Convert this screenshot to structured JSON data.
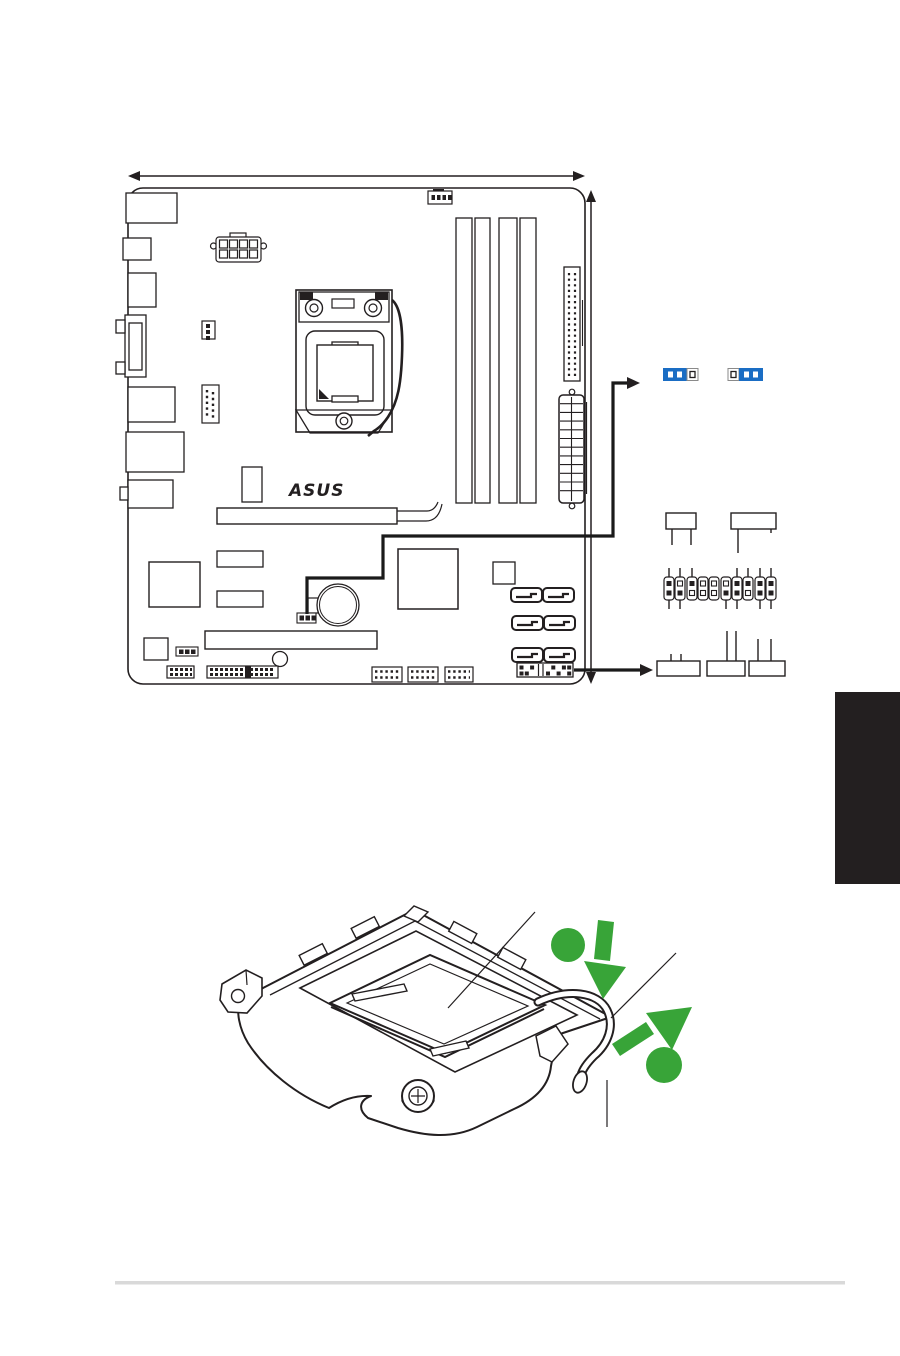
{
  "page": {
    "background": "#ffffff",
    "width": 900,
    "height": 1356,
    "footer_divider_color": "#d9d9d9"
  },
  "colors": {
    "line": "#231f20",
    "jumper_cap_blue": "#1a6dc4",
    "accent_green": "#38a438",
    "chapter_tab": "#231f20"
  },
  "figures": {
    "motherboard": {
      "name": "motherboard-layout-top-view",
      "logo": "ASUS",
      "dimension_arrows": [
        "board-width-arrow-horizontal",
        "board-height-arrow-vertical"
      ],
      "parts": [
        "rear-io-ports",
        "cpu-fan-header",
        "atx12v-8pin-connector",
        "chassis-fan-header",
        "com-port-header",
        "lga-cpu-socket",
        "dimm-slots-x4",
        "ide-connector",
        "atx-24pin-connector",
        "pcie-x16-slot",
        "pcie-x1-slot",
        "chipset-chips",
        "cmos-battery",
        "clrtc-jumper",
        "sata-ports-x6",
        "front-panel-header",
        "usb-headers-x3",
        "audio-and-misc-headers"
      ],
      "callouts": {
        "clrtc_jumper_settings": [
          "cap-on-pins-1-2",
          "cap-on-pins-2-3"
        ],
        "system_panel_diagram": {
          "top_boxes_with_pins_down": 2,
          "bottom_boxes_with_pins_up": 3,
          "panel_header": {
            "columns": 10,
            "top_filled": [
              1,
              0,
              1,
              0,
              0,
              0,
              1,
              1,
              1,
              1
            ],
            "bottom_filled": [
              1,
              1,
              0,
              0,
              0,
              1,
              1,
              0,
              1,
              1
            ],
            "lines_up": [
              1,
              1,
              1,
              0,
              0,
              0,
              1,
              1,
              1,
              1
            ],
            "lines_down": [
              1,
              1,
              0,
              0,
              0,
              1,
              1,
              0,
              1,
              1
            ]
          }
        }
      }
    },
    "cpu_socket": {
      "name": "cpu-socket-load-plate-illustration",
      "annotations": [
        "callout-line-to-cpu",
        "callout-line-to-load-plate",
        "callout-line-to-lever-tip",
        "green-step-dot-1",
        "green-down-arrow",
        "green-up-right-arrow",
        "green-step-dot-2"
      ]
    }
  }
}
